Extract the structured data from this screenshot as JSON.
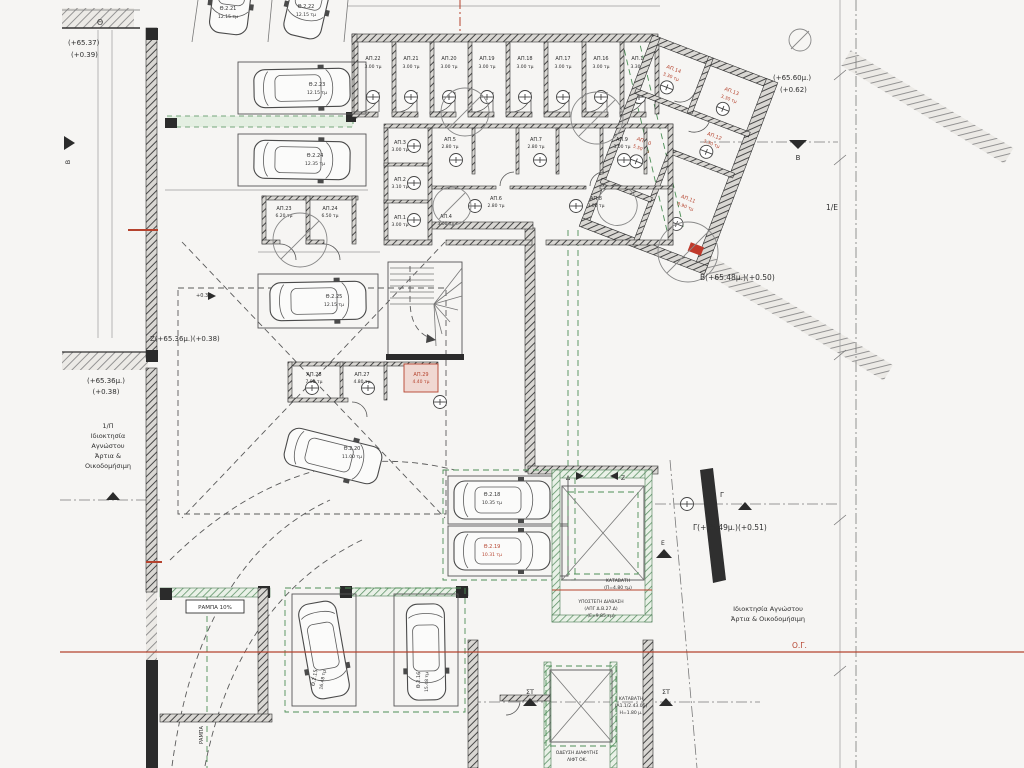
{
  "palette": {
    "wall": "#3a3a3a",
    "red": "#b5432e",
    "green": "#4d8f57",
    "bg": "#f6f5f3"
  },
  "elevations": {
    "theta_letter": "Θ",
    "theta1": "(+65.37)",
    "theta2": "(+0.39)",
    "btop1": "(+65.60μ.)",
    "btop2": "(+0.62)",
    "bline": "Β(+65.48μ.)(+0.50)",
    "zline": "Ζ(+65.36μ.)(+0.38)",
    "left1": "(+65.36μ.)",
    "left2": "(+0.38)",
    "gline": "Γ(+65.49μ.)(+0.51)"
  },
  "markers": {
    "b": "Β",
    "gamma": "Γ",
    "delta": "Δ",
    "zeta": "Ζ",
    "st": "ΣΤ",
    "e": "Ε",
    "one_e": "1/Ε",
    "og": "Ο.Γ.",
    "level": "+0.38"
  },
  "ownership_left": {
    "l1": "1/Π",
    "l2": "Ιδιοκτησία",
    "l3": "Αγνώστου",
    "l4": "Άρτια &",
    "l5": "Οικοδομήσιμη"
  },
  "ownership_right": {
    "l1": "Ιδιοκτησία Αγνώστου",
    "l2": "Άρτια & Οικοδομήσιμη"
  },
  "storage": {
    "ap22": {
      "name": "ΑΠ.22",
      "area": "3.00 τμ"
    },
    "ap21": {
      "name": "ΑΠ.21",
      "area": "3.00 τμ"
    },
    "ap20": {
      "name": "ΑΠ.20",
      "area": "3.00 τμ"
    },
    "ap19": {
      "name": "ΑΠ.19",
      "area": "3.00 τμ"
    },
    "ap18": {
      "name": "ΑΠ.18",
      "area": "3.00 τμ"
    },
    "ap17": {
      "name": "ΑΠ.17",
      "area": "3.00 τμ"
    },
    "ap16": {
      "name": "ΑΠ.16",
      "area": "3.00 τμ"
    },
    "ap15": {
      "name": "ΑΠ.15",
      "area": "3.30 τμ"
    }
  },
  "wing": {
    "ap14": {
      "name": "ΑΠ.14",
      "area": "3.30 τμ"
    },
    "ap13": {
      "name": "ΑΠ.13",
      "area": "3.30 τμ"
    },
    "ap12": {
      "name": "ΑΠ.12",
      "area": "3.30 τμ"
    },
    "ap11": {
      "name": "ΑΠ.11",
      "area": "8.90 τμ"
    },
    "ap10": {
      "name": "ΑΠ.10",
      "area": "5.50 τμ"
    }
  },
  "rooms": {
    "ap1": {
      "name": "ΑΠ.1",
      "area": "3.00 τμ"
    },
    "ap2": {
      "name": "ΑΠ.2",
      "area": "3.10 τμ"
    },
    "ap3": {
      "name": "ΑΠ.3",
      "area": "3.00 τμ"
    },
    "ap4": {
      "name": "ΑΠ.4",
      "area": "3.00 τμ"
    },
    "ap5": {
      "name": "ΑΠ.5",
      "area": "2.80 τμ"
    },
    "ap6": {
      "name": "ΑΠ.6",
      "area": "2.80 τμ"
    },
    "ap7": {
      "name": "ΑΠ.7",
      "area": "2.80 τμ"
    },
    "ap8": {
      "name": "ΑΠ.8",
      "area": "3.00 τμ"
    },
    "ap9": {
      "name": "ΑΠ.9",
      "area": "3.00 τμ"
    },
    "ap23": {
      "name": "ΑΠ.23",
      "area": "6.20 τμ"
    },
    "ap24": {
      "name": "ΑΠ.24",
      "area": "6.50 τμ"
    },
    "ap27": {
      "name": "ΑΠ.27",
      "area": "4.80 τμ"
    },
    "ap28": {
      "name": "ΑΠ.28",
      "area": "7.80 τμ"
    },
    "ap29": {
      "name": "ΑΠ.29",
      "area": "4.40 τμ"
    }
  },
  "parking": {
    "p15": {
      "name": "Θ.2.15",
      "area": "16.48 τμ"
    },
    "p16": {
      "name": "Θ.2.16",
      "area": "15.48 τμ"
    },
    "p18": {
      "name": "Θ.2.18",
      "area": "10.35 τμ"
    },
    "p19": {
      "name": "Θ.2.19",
      "area": "10.31 τμ"
    },
    "p20": {
      "name": "Θ.2.20",
      "area": "11.00 τμ"
    },
    "p21": {
      "name": "Θ.2.21",
      "area": "12.15 τμ"
    },
    "p22": {
      "name": "Θ.2.22",
      "area": "12.15 τμ"
    },
    "p23": {
      "name": "Θ.2.23",
      "area": "12.15 τμ"
    },
    "p24": {
      "name": "Θ.2.24",
      "area": "12.35 τμ"
    },
    "p25": {
      "name": "Θ.2.25",
      "area": "12.15 τμ"
    }
  },
  "shaft": {
    "y1": "ΥΠΟΣΤΕΓΗ ΔΙΑΒΑΣΗ",
    "y2": "(ΑΠΓ Δ.Β.27.Δ)",
    "y3": "(Ε=9.85 τμ)",
    "k1": "ΚΑΤΑΒΑΤΗ",
    "k2": "(Π=4.80 τμ)",
    "k3": "ΚΑΤΑΒΑΤΗ",
    "k4": "(Α1.1/2.43.05)",
    "k5": "Η=1.80 μ.",
    "o1": "ΟΔΕΥΣΗ ΔΙΑΦΥΓΗΣ",
    "o2": "ΛΙΦΤ ΟΚ."
  },
  "misc": {
    "ramp": "ΡΑΜΠΑ 10%",
    "ramp_side": "ΡΑΜΠΑ"
  }
}
